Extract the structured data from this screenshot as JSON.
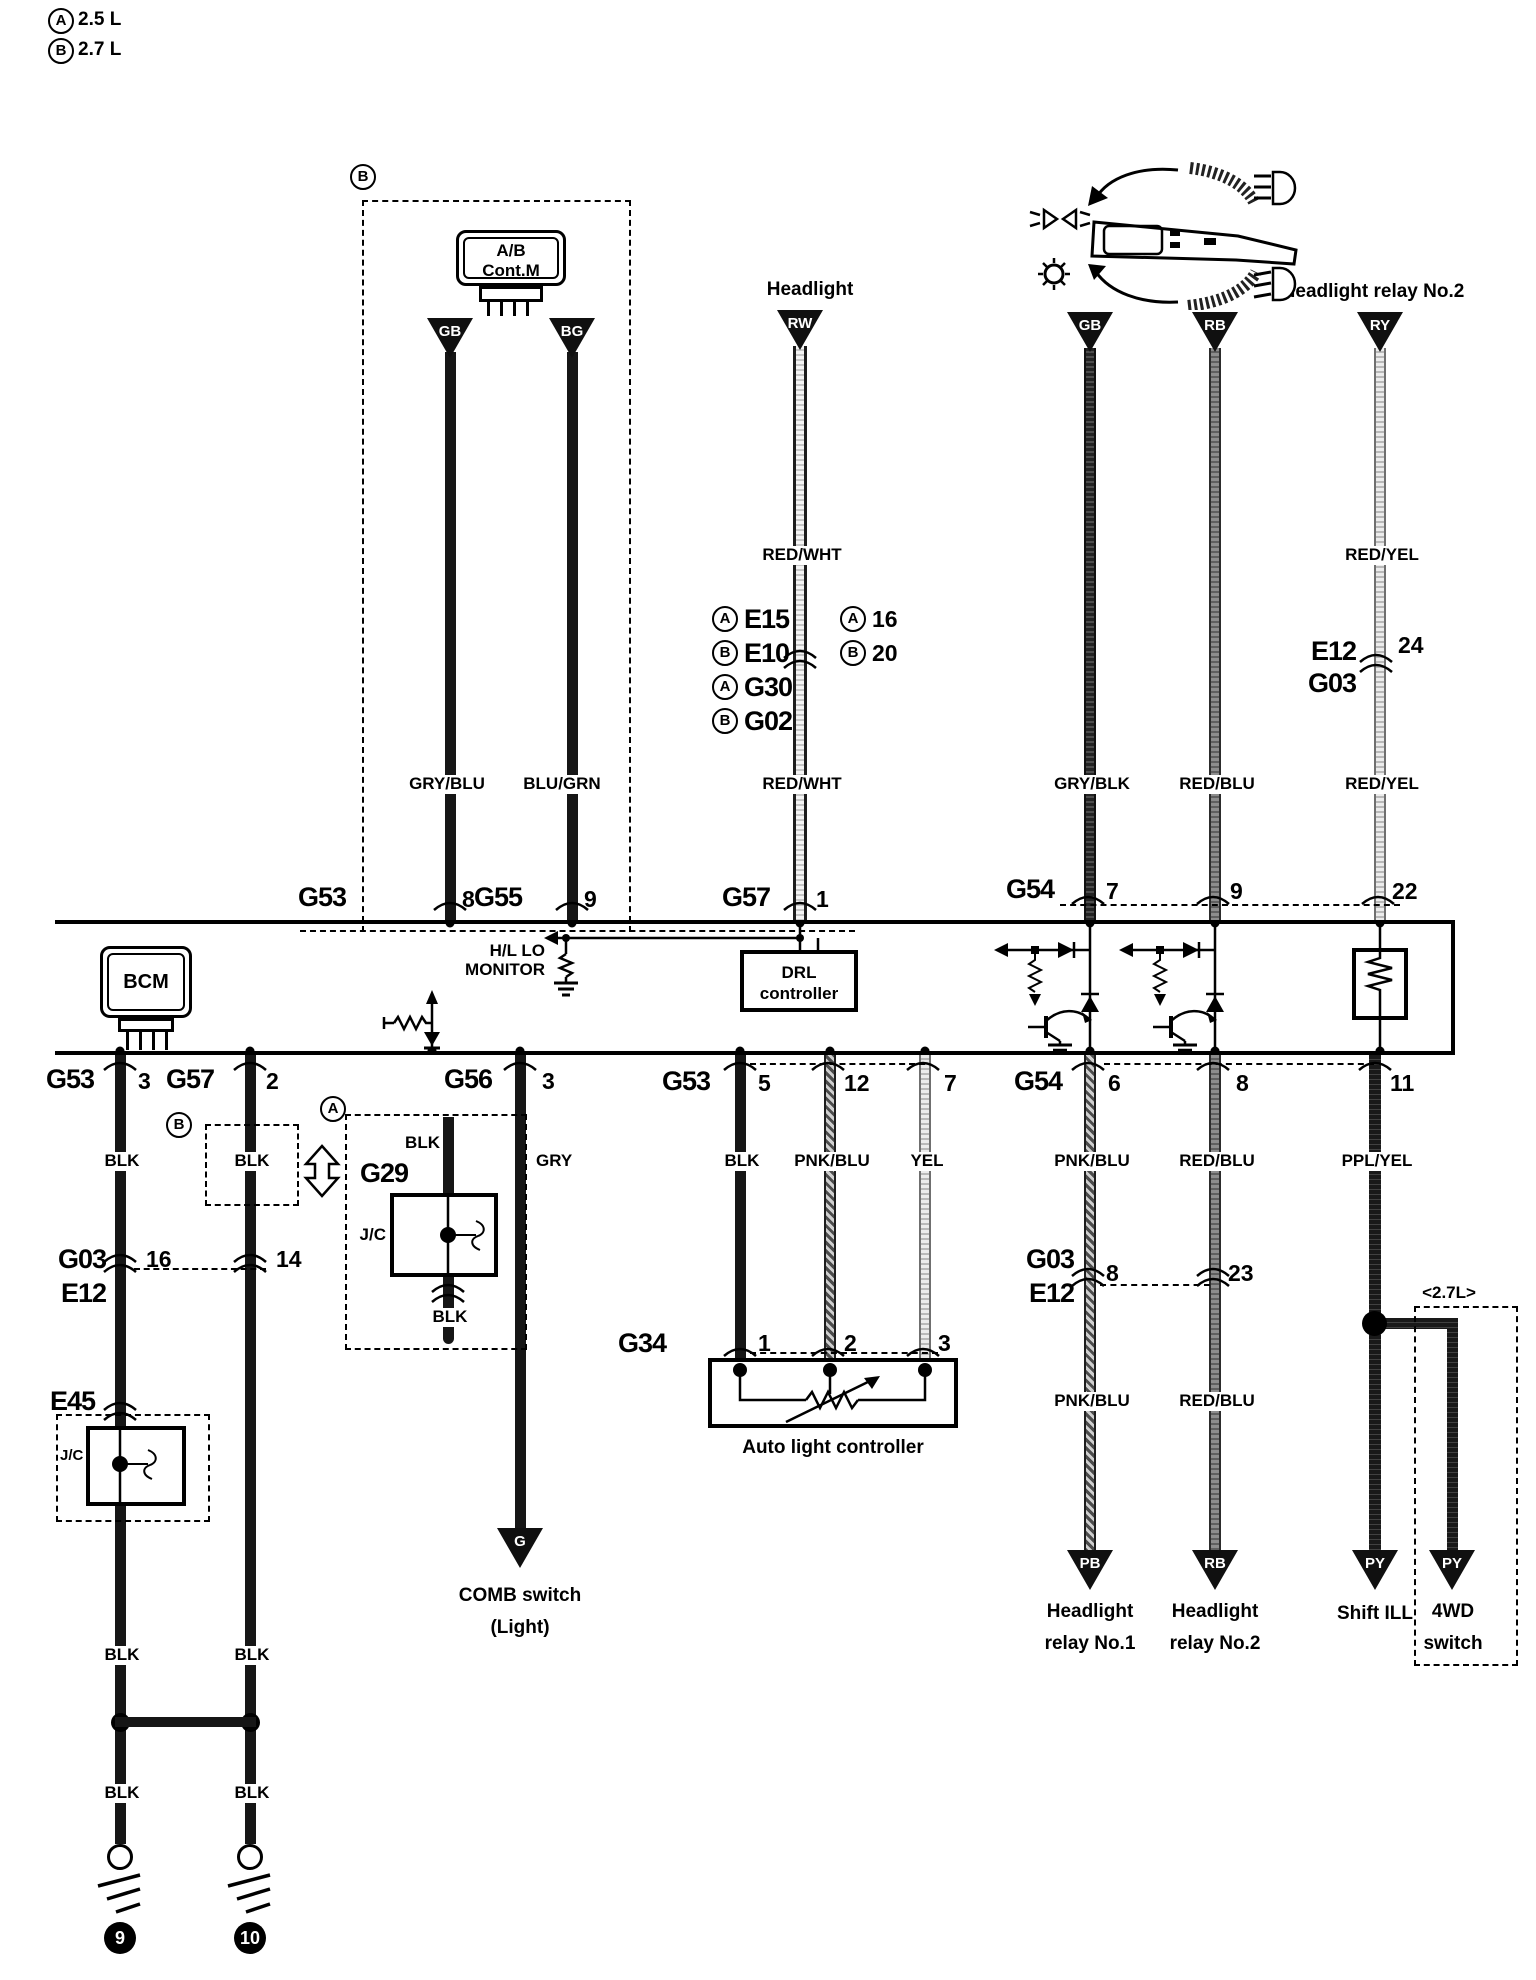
{
  "legend": {
    "a_letter": "A",
    "a_text": "2.5 L",
    "b_letter": "B",
    "b_text": "2.7 L"
  },
  "headings": {
    "headlight": "Headlight",
    "headlight_relay2": "Headlight relay No.2"
  },
  "terminals": {
    "gb": "GB",
    "bg": "BG",
    "rw": "RW",
    "rb": "RB",
    "ry": "RY",
    "g": "G",
    "pb": "PB",
    "py": "PY"
  },
  "wire_labels": {
    "gry_blu": "GRY/BLU",
    "blu_grn": "BLU/GRN",
    "red_wht": "RED/WHT",
    "gry_blk": "GRY/BLK",
    "red_blu": "RED/BLU",
    "red_yel": "RED/YEL",
    "blk": "BLK",
    "gry": "GRY",
    "pnk_blu": "PNK/BLU",
    "yel": "YEL",
    "ppl_yel": "PPL/YEL"
  },
  "modules": {
    "ab": {
      "variant_letter": "B",
      "line1": "A/B",
      "line2": "Cont.M"
    },
    "bcm": "BCM",
    "monitor": {
      "line1": "H/L LO",
      "line2": "MONITOR"
    },
    "drl": {
      "line1": "DRL",
      "line2": "controller"
    },
    "auto_light": "Auto light controller",
    "g29": {
      "variant_letter": "A",
      "name": "G29",
      "jc": "J/C"
    },
    "e45": {
      "name": "E45",
      "jc": "J/C"
    },
    "variant_b_letter": "B"
  },
  "connectors": {
    "row1": {
      "g53": "G53",
      "g53_pin": "8",
      "g55": "G55",
      "g55_pin": "9",
      "g57": "G57",
      "g57_pin": "1",
      "g54": "G54",
      "g54_pin1": "7",
      "g54_pin2": "9",
      "g54_pin3": "22"
    },
    "row2": {
      "g53": "G53",
      "g53_pin": "3",
      "g57": "G57",
      "g57_pin": "2",
      "g56": "G56",
      "g56_pin": "3",
      "g53b": "G53",
      "g53b_pin1": "5",
      "g53b_pin2": "12",
      "g53b_pin3": "7",
      "g54": "G54",
      "g54_pin1": "6",
      "g54_pin2": "8",
      "g54_pin3": "11"
    },
    "g34": {
      "name": "G34",
      "pin1": "1",
      "pin2": "2",
      "pin3": "3"
    }
  },
  "splices": {
    "mid": {
      "r1_letter": "A",
      "r1_name": "E15",
      "r2_letter": "B",
      "r2_name": "E10",
      "r3_letter": "A",
      "r3_name": "G30",
      "r4_letter": "B",
      "r4_name": "G02",
      "p1_letter": "A",
      "p1_num": "16",
      "p2_letter": "B",
      "p2_num": "20"
    },
    "top_right": {
      "line1": "E12",
      "line2": "G03",
      "pin": "24"
    },
    "left": {
      "line1": "G03",
      "line2": "E12",
      "pin1": "16",
      "pin2": "14"
    },
    "right": {
      "line1": "G03",
      "line2": "E12",
      "pin1": "8",
      "pin2": "23"
    }
  },
  "bottom": {
    "comb_line1": "COMB switch",
    "comb_line2": "(Light)",
    "relay1_line1": "Headlight",
    "relay1_line2": "relay No.1",
    "relay2_line1": "Headlight",
    "relay2_line2": "relay No.2",
    "shift": "Shift ILL",
    "fourwd_line1": "4WD",
    "fourwd_line2": "switch",
    "note_27": "<2.7L>",
    "ground1": "9",
    "ground2": "10"
  }
}
